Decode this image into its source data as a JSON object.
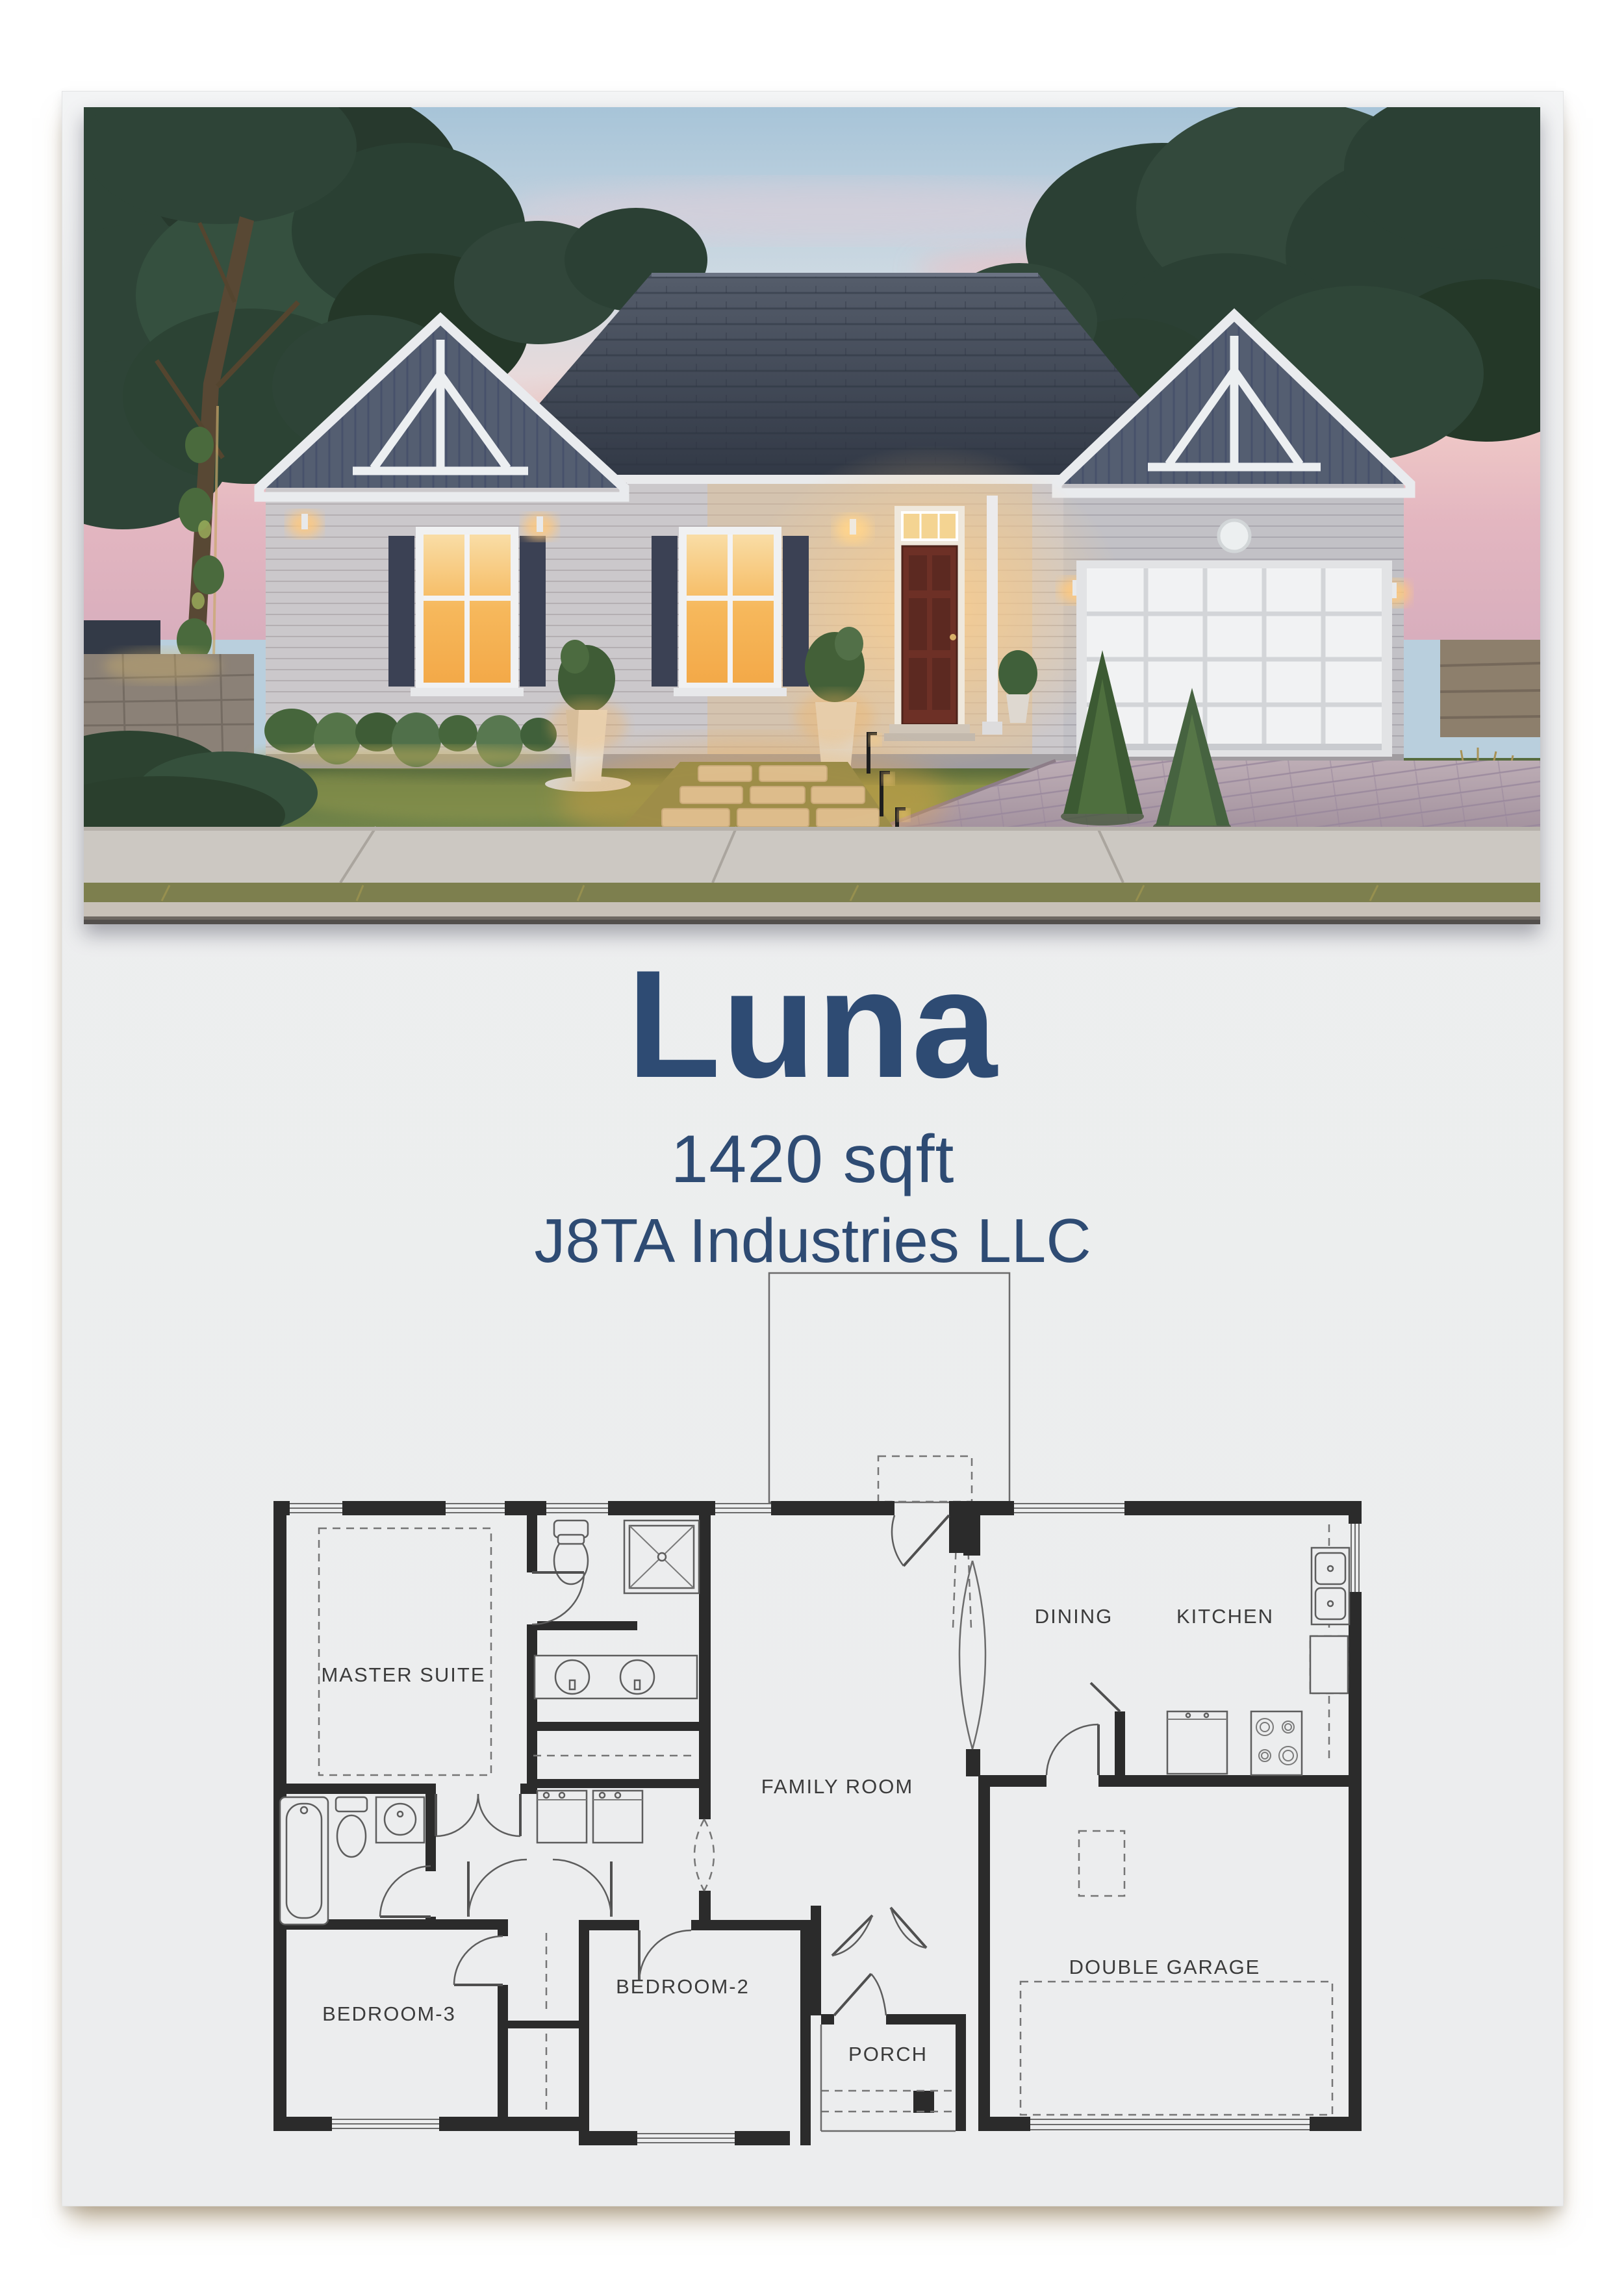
{
  "flyer": {
    "plan_name": "Luna",
    "area": "1420 sqft",
    "builder": "J8TA Industries LLC"
  },
  "floor_plan": {
    "labels": {
      "master_suite": "MASTER SUITE",
      "family_room": "FAMILY ROOM",
      "dining": "DINING",
      "kitchen": "KITCHEN",
      "double_garage": "DOUBLE GARAGE",
      "bedroom_2": "BEDROOM-2",
      "bedroom_3": "BEDROOM-3",
      "porch": "PORCH"
    }
  },
  "colors": {
    "title_text": "#2e4b73",
    "page_background": "#ecedee",
    "plan_walls": "#2b2b2b",
    "photo_sky_top": "#a7c4d8",
    "photo_sky_pink": "#eec6c6",
    "photo_roof": "#39404d",
    "photo_siding": "#cac7ca",
    "photo_shutters": "#3b4154",
    "photo_window_glow": "#f6b85c",
    "photo_front_door": "#6d3026",
    "photo_lawn": "#5f7345",
    "photo_driveway": "#b2a2ad"
  }
}
